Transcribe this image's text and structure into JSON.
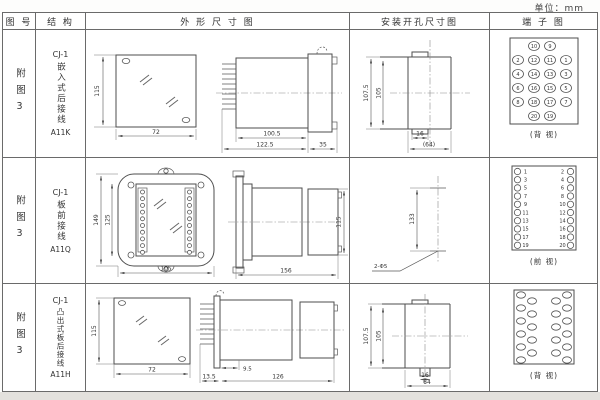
{
  "page": {
    "unit_label": "单位：mm"
  },
  "table": {
    "headers": [
      "图 号",
      "结 构",
      "外 形 尺 寸 图",
      "安装开孔尺寸图",
      "端 子 图"
    ]
  },
  "rows": [
    {
      "figure_no": "附图3",
      "structure_model": "CJ-1",
      "structure_desc": "嵌入式后接线",
      "structure_code": "A11K",
      "outline": {
        "front_h": "115",
        "front_w": "72",
        "len_body": "100.5",
        "len_total": "122.5",
        "flange": "35"
      },
      "install": {
        "v_outer": "107.5",
        "v_inner": "105",
        "h_small": "16",
        "h_total": "(64)"
      },
      "terminal": {
        "view_label": "(背 视)",
        "grid": [
          [
            null,
            "10",
            "9",
            null
          ],
          [
            "2",
            "12",
            "11",
            "1"
          ],
          [
            "4",
            "14",
            "13",
            "3"
          ],
          [
            "6",
            "16",
            "15",
            "5"
          ],
          [
            "8",
            "18",
            "17",
            "7"
          ],
          [
            null,
            "20",
            "19",
            null
          ]
        ]
      }
    },
    {
      "figure_no": "附图3",
      "structure_model": "CJ-1",
      "structure_desc": "板前接线",
      "structure_code": "A11Q",
      "outline": {
        "front_h_outer": "149",
        "front_h_inner": "125",
        "front_w": "105",
        "len_total": "156",
        "rear_h": "115"
      },
      "install": {
        "v_span": "133",
        "hole_note": "2-Φ5"
      },
      "terminal": {
        "view_label": "(前 视)",
        "left_numbers": [
          "1",
          "3",
          "5",
          "7",
          "9",
          "11",
          "13",
          "15",
          "17",
          "19"
        ],
        "right_numbers": [
          "2",
          "4",
          "6",
          "8",
          "10",
          "12",
          "14",
          "16",
          "18",
          "20"
        ]
      }
    },
    {
      "figure_no": "附图3",
      "structure_model": "CJ-1",
      "structure_desc": "凸出式板后接线",
      "structure_code": "A11H",
      "outline": {
        "front_h": "115",
        "front_w": "72",
        "pin_len": "13.5",
        "step": "9.5",
        "len_total": "126"
      },
      "install": {
        "v_outer": "107.5",
        "v_inner": "105",
        "h_small": "16",
        "h_total": "64"
      },
      "terminal": {
        "view_label": "(背 视)"
      }
    }
  ]
}
